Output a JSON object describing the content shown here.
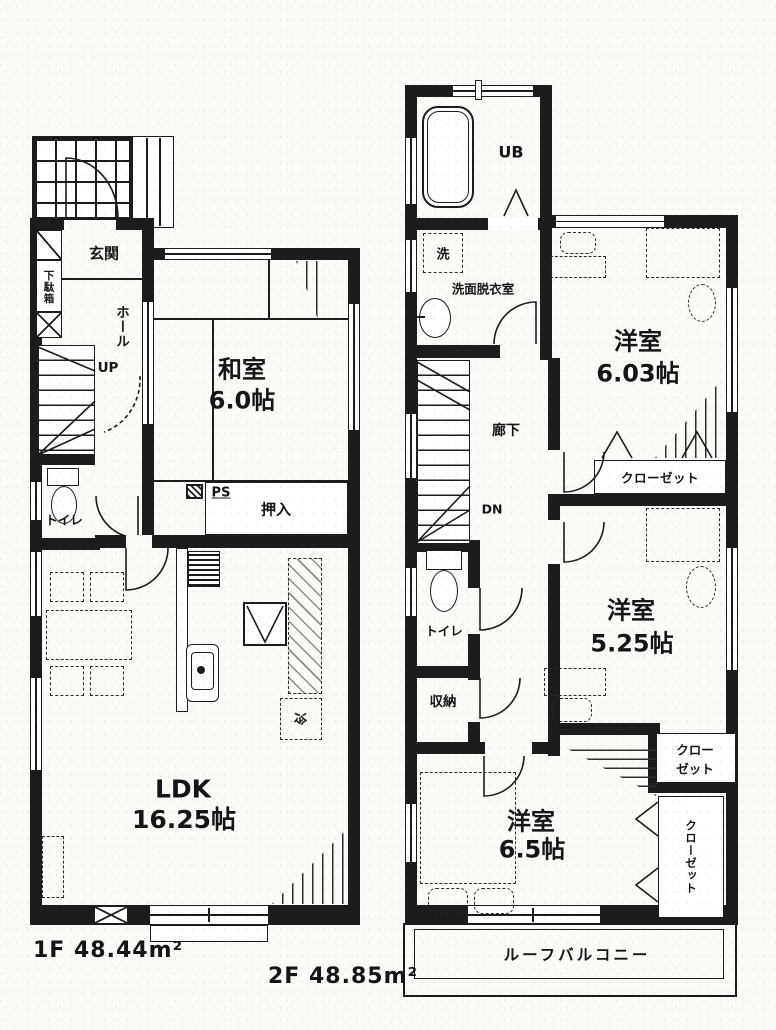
{
  "floor1": {
    "area_label": "1F 48.44m²",
    "labels": {
      "genkan": "玄関",
      "getabako": "下駄箱",
      "hall": "ホール",
      "up": "UP",
      "washitsu_name": "和室",
      "washitsu_size": "6.0帖",
      "toilet": "トイレ",
      "ps": "PS",
      "oshiire": "押入",
      "ldk_name": "LDK",
      "ldk_size": "16.25帖",
      "fridge": "冷"
    }
  },
  "floor2": {
    "area_label": "2F 48.85m²",
    "labels": {
      "ub": "UB",
      "washer": "洗",
      "washroom": "洗面脱衣室",
      "corridor": "廊下",
      "dn": "DN",
      "room1_name": "洋室",
      "room1_size": "6.03帖",
      "closet1": "クローゼット",
      "room2_name": "洋室",
      "room2_size": "5.25帖",
      "toilet": "トイレ",
      "storage": "収納",
      "closet2_line1": "クロー",
      "closet2_line2": "ゼット",
      "room3_name": "洋室",
      "room3_size": "6.5帖",
      "closet3": "クローゼット",
      "roof_balcony": "ルーフバルコニー"
    }
  }
}
